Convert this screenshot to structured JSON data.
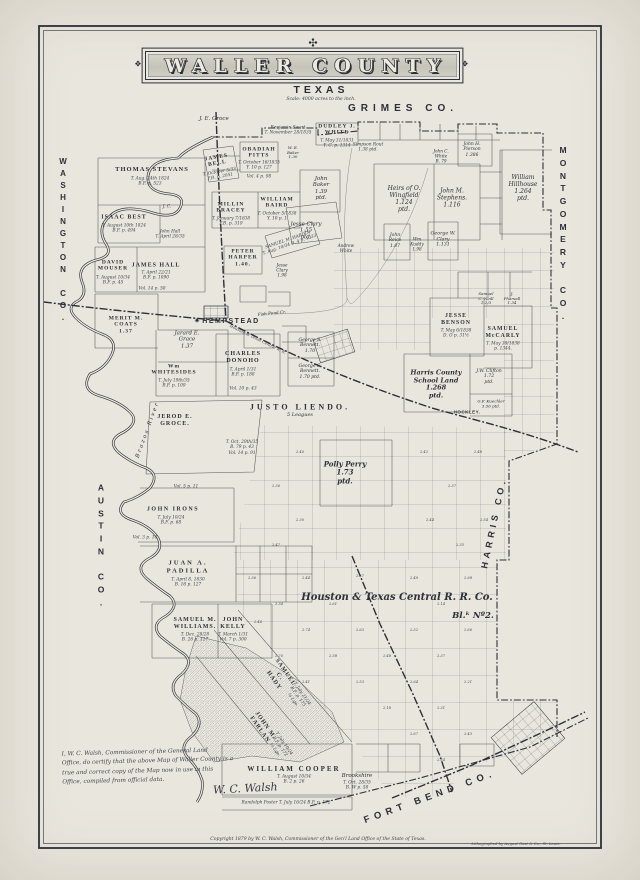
{
  "page": {
    "paper": "#e9e6de",
    "ink": "#2c3038"
  },
  "title": {
    "name": "WALLER COUNTY",
    "state": "TEXAS",
    "scale": "Scale: 4000 acres to the inch."
  },
  "icons": {
    "ornament_top": "✣",
    "banner_side": "❖",
    "courthouse_star": "✷"
  },
  "certificate": {
    "lines": [
      "I, W. C. Walsh, Commissioner of the General Land",
      "Office, do certify that the above Map of Waller County is a",
      "true and correct copy of the Map now in use in this",
      "Office, compiled from official data."
    ],
    "signature": "W. C. Walsh"
  },
  "footer": {
    "copyright": "Copyright 1879 by W. C. Walsh, Commissioner of the Gen'l Land Office of the State of Texas.",
    "lithographer": "Lithographed by August Gast & Co., St. Louis."
  },
  "map_labels": [
    {
      "n": "county-washington",
      "t": "WASHINGTON CO.",
      "x": 63,
      "y": 240,
      "cls": "vstack",
      "fs": 8
    },
    {
      "n": "county-austin",
      "t": "AUSTIN CO.",
      "x": 101,
      "y": 545,
      "cls": "vstack",
      "fs": 8.5
    },
    {
      "n": "county-grimes",
      "t": "GRIMES CO.",
      "x": 403,
      "y": 109,
      "cls": "county-h",
      "fs": 10,
      "ls": 5
    },
    {
      "n": "county-montgomery",
      "t": "MONTGOMERY CO.",
      "x": 563,
      "y": 233,
      "cls": "vstack",
      "fs": 8.5
    },
    {
      "n": "county-harris",
      "t": "HARRIS CO.",
      "x": 494,
      "y": 523,
      "cls": "county-h",
      "fs": 9,
      "ls": 4,
      "rot": -78
    },
    {
      "n": "county-fortbend",
      "t": "FORT BEND CO.",
      "x": 430,
      "y": 797,
      "cls": "county-h",
      "fs": 9.5,
      "ls": 5,
      "rot": -20
    },
    {
      "n": "town-hempstead",
      "t": "HEMPSTEAD",
      "x": 231,
      "y": 322,
      "cls": "town",
      "fs": 7,
      "ls": 1.5
    },
    {
      "n": "courthouse-star",
      "t": "✷",
      "x": 197,
      "y": 322,
      "cls": "town",
      "fs": 6
    },
    {
      "n": "town-hockley",
      "t": "HOCKLEY.",
      "x": 467,
      "y": 412,
      "cls": "town",
      "fs": 4.5,
      "ls": 0.5
    },
    {
      "n": "town-brookshire",
      "t": "Brookshire",
      "x": 357,
      "y": 776,
      "cls": "script",
      "fs": 5.5
    },
    {
      "t": "T. Oct. 28/35\nB. W p. 58",
      "x": 357,
      "y": 786,
      "cls": "note"
    },
    {
      "t": "J. E. Groce",
      "x": 214,
      "y": 119,
      "cls": "script",
      "fs": 5.5
    },
    {
      "t": "THOMAS STEVANS",
      "x": 152,
      "y": 170,
      "cls": "caps",
      "fs": 6.5
    },
    {
      "t": "T. Aug. 24th 1824\nB.F. p. 523",
      "x": 150,
      "y": 182,
      "cls": "note"
    },
    {
      "t": "ISAAC BEST",
      "x": 124,
      "y": 218,
      "cls": "caps",
      "fs": 6
    },
    {
      "t": "T. August 10th 1824\nB.F. p. 494",
      "x": 124,
      "y": 229,
      "cls": "note"
    },
    {
      "t": "J. C.",
      "x": 167,
      "y": 207,
      "cls": "note"
    },
    {
      "t": "John Hall\nT. April 28/35",
      "x": 170,
      "y": 235,
      "cls": "note"
    },
    {
      "t": "DAVID\nMOUSER",
      "x": 113,
      "y": 266,
      "cls": "caps",
      "fs": 5.5
    },
    {
      "t": "T. August 10/34\nB.F. p. 45",
      "x": 113,
      "y": 281,
      "cls": "note"
    },
    {
      "t": "JAMES HALL",
      "x": 156,
      "y": 266,
      "cls": "caps",
      "fs": 6
    },
    {
      "t": "T. April 22/21\nB.F. p. 1090",
      "x": 156,
      "y": 276,
      "cls": "note"
    },
    {
      "t": "Vol. 14 p. 58",
      "x": 152,
      "y": 289,
      "cls": "note"
    },
    {
      "t": "MERIT M.\nCOATS\n1.37",
      "x": 126,
      "y": 325,
      "cls": "caps",
      "fs": 5.5
    },
    {
      "t": "Jarard E.\nGrace\n1.37",
      "x": 187,
      "y": 340,
      "cls": "script",
      "fs": 5.5
    },
    {
      "t": "Wm\nWHITESIDES",
      "x": 174,
      "y": 370,
      "cls": "caps",
      "fs": 5.5
    },
    {
      "t": "T. July 19th/35\nB.F. p. 109",
      "x": 174,
      "y": 384,
      "cls": "note"
    },
    {
      "t": "CHARLES\nDONOHO",
      "x": 243,
      "y": 358,
      "cls": "caps",
      "fs": 6
    },
    {
      "t": "T. April 1/31\nB.F. p. 188",
      "x": 243,
      "y": 373,
      "cls": "note"
    },
    {
      "t": "Vol. 10 p. 43",
      "x": 243,
      "y": 389,
      "cls": "note"
    },
    {
      "t": "JEROD E.\nGROCE.",
      "x": 175,
      "y": 421,
      "cls": "caps",
      "fs": 6
    },
    {
      "t": "T. Oct. 29th/35\nB. 79 p. 43\nVol. 14 p. 91",
      "x": 242,
      "y": 448,
      "cls": "note"
    },
    {
      "t": "Brazos River",
      "x": 148,
      "y": 430,
      "cls": "script",
      "fs": 5.5,
      "rot": -70,
      "ls": 2
    },
    {
      "t": "Vol. 5 p. 11",
      "x": 186,
      "y": 487,
      "cls": "note"
    },
    {
      "t": "JOHN IRONS",
      "x": 173,
      "y": 510,
      "cls": "caps",
      "fs": 6,
      "ls": 1.5
    },
    {
      "t": "T. July 10/24\nB.F. p. 68",
      "x": 171,
      "y": 521,
      "cls": "note"
    },
    {
      "t": "Vol. 3 p. 14",
      "x": 145,
      "y": 538,
      "cls": "note"
    },
    {
      "t": "JUAN A.\nPADILLA",
      "x": 188,
      "y": 567,
      "cls": "caps",
      "fs": 6.5,
      "ls": 2
    },
    {
      "t": "T. April 8, 1830\nB. 16 p. 127",
      "x": 188,
      "y": 583,
      "cls": "note"
    },
    {
      "t": "SAMUEL M.\nWILLIAMS.",
      "x": 195,
      "y": 624,
      "cls": "caps",
      "fs": 6
    },
    {
      "t": "T. Dec. 28/28\nB. 26 p. 117",
      "x": 195,
      "y": 638,
      "cls": "note"
    },
    {
      "t": "JOHN\nKELLY",
      "x": 233,
      "y": 624,
      "cls": "caps",
      "fs": 6
    },
    {
      "t": "T. March 1/31\nVol. 7 p. 300",
      "x": 233,
      "y": 638,
      "cls": "note"
    },
    {
      "t": "JAMES\nBELL",
      "x": 217,
      "y": 161,
      "cls": "caps",
      "fs": 5.5,
      "rot": -10
    },
    {
      "t": "T. October 5/33\nF.B. p. 2051",
      "x": 220,
      "y": 175,
      "cls": "note",
      "rot": -10
    },
    {
      "t": "OBADIAH\nPITTS",
      "x": 259,
      "y": 153,
      "cls": "caps",
      "fs": 5.5
    },
    {
      "t": "T. October 16/1835\nY. 10 p. 127",
      "x": 259,
      "y": 166,
      "cls": "note"
    },
    {
      "t": "Vol. 4 p. 98",
      "x": 259,
      "y": 177,
      "cls": "note"
    },
    {
      "t": "DUDLEY J.\nWHITE",
      "x": 337,
      "y": 130,
      "cls": "caps",
      "fs": 5.5
    },
    {
      "t": "T. May 31/1831\nY. C. p. 1314",
      "x": 337,
      "y": 144,
      "cls": "note"
    },
    {
      "t": "Benjamin Swart\nT. November 28/1835",
      "x": 288,
      "y": 131,
      "cls": "note"
    },
    {
      "t": "Simpson Rout\n1.38  ptd.",
      "x": 368,
      "y": 148,
      "cls": "note"
    },
    {
      "t": "W. E.\nBaker\n1.30",
      "x": 293,
      "y": 153,
      "cls": "script",
      "fs": 4
    },
    {
      "t": "MILLIN\nBRACEY",
      "x": 231,
      "y": 208,
      "cls": "caps",
      "fs": 5.5
    },
    {
      "t": "T. January 7/1838\nF.B. p. 319",
      "x": 231,
      "y": 222,
      "cls": "note"
    },
    {
      "t": "WILLIAM\nBAIRD",
      "x": 277,
      "y": 203,
      "cls": "caps",
      "fs": 5.5
    },
    {
      "t": "T. October 5/1838\nY. 10 p. 1",
      "x": 277,
      "y": 217,
      "cls": "note"
    },
    {
      "t": "John\nBaker\n1.39\nptd.",
      "x": 321,
      "y": 189,
      "cls": "script",
      "fs": 5.5
    },
    {
      "t": "Jesse Clary\n1.55\nptd.",
      "x": 306,
      "y": 231,
      "cls": "script",
      "fs": 5.5
    },
    {
      "t": "SAMUEL M. HARDIN\nT. Aug. 10/34  B. 4 p. 1033",
      "x": 289,
      "y": 243,
      "cls": "note",
      "rot": -19
    },
    {
      "t": "PETER\nHARPER\n1.40.",
      "x": 243,
      "y": 258,
      "cls": "caps",
      "fs": 5.5
    },
    {
      "t": "Jesse\nClary\n1.98",
      "x": 282,
      "y": 271,
      "cls": "script",
      "fs": 4.2
    },
    {
      "t": "Andrew\nWhite",
      "x": 346,
      "y": 249,
      "cls": "script",
      "fs": 4.2
    },
    {
      "t": "Heirs of O.\nWingfield\n1.124\nptd.",
      "x": 404,
      "y": 199,
      "cls": "script",
      "fs": 6
    },
    {
      "t": "John M.\nStephens.\n1.116",
      "x": 452,
      "y": 198,
      "cls": "script",
      "fs": 6
    },
    {
      "t": "William\nHillhouse\n1.264\nptd.",
      "x": 523,
      "y": 188,
      "cls": "script",
      "fs": 6
    },
    {
      "t": "John H.\nPierson\n1.386",
      "x": 472,
      "y": 150,
      "cls": "script",
      "fs": 4.5
    },
    {
      "t": "John C.\nWhite\nB. 79",
      "x": 441,
      "y": 157,
      "cls": "script",
      "fs": 4.2
    },
    {
      "t": "George W.\nClary\n1.131",
      "x": 443,
      "y": 240,
      "cls": "script",
      "fs": 4.8
    },
    {
      "t": "John\nReice\n1.87",
      "x": 395,
      "y": 241,
      "cls": "script",
      "fs": 4.5
    },
    {
      "t": "Wm\nKuddy\n1.98",
      "x": 417,
      "y": 245,
      "cls": "script",
      "fs": 4.2
    },
    {
      "t": "JESSE\nBENSON",
      "x": 456,
      "y": 320,
      "cls": "caps",
      "fs": 5.8
    },
    {
      "t": "T. May 6/1838\nD. O p. 31½",
      "x": 456,
      "y": 334,
      "cls": "note"
    },
    {
      "t": "SAMUEL\nMcCARLY",
      "x": 503,
      "y": 333,
      "cls": "caps",
      "fs": 5.8
    },
    {
      "t": "T. May 30/1838\np. 1344.",
      "x": 503,
      "y": 347,
      "cls": "note"
    },
    {
      "t": "Samuel\nC. Neill\n1.2/3",
      "x": 486,
      "y": 299,
      "cls": "script",
      "fs": 4
    },
    {
      "t": "J.\nPharsall\n1.34",
      "x": 512,
      "y": 299,
      "cls": "script",
      "fs": 4
    },
    {
      "t": "Harris County\nSchool Land\n1.268\nptd.",
      "x": 436,
      "y": 385,
      "cls": "sb",
      "fs": 6.5
    },
    {
      "t": "J.W. Clifton\n1.72\nptd.",
      "x": 489,
      "y": 377,
      "cls": "script",
      "fs": 4.6
    },
    {
      "t": "G.F. Kuechler\n3.56  ptd.",
      "x": 491,
      "y": 404,
      "cls": "script",
      "fs": 4
    },
    {
      "t": "George S.\nBennett.\n1.70",
      "x": 310,
      "y": 346,
      "cls": "script",
      "fs": 4.6
    },
    {
      "t": "George S.\nBennett.\n1.70  ptd.",
      "x": 310,
      "y": 372,
      "cls": "script",
      "fs": 4.6
    },
    {
      "t": "Fish Pond  Cr.",
      "x": 272,
      "y": 314,
      "cls": "script",
      "fs": 4.2,
      "rot": -6
    },
    {
      "t": "Houston & Texas Central R. R.",
      "x": 258,
      "y": 339,
      "cls": "note",
      "rot": 26,
      "fs": 4
    },
    {
      "t": "JUSTO LIENDO.",
      "x": 300,
      "y": 407,
      "cls": "caps",
      "fs": 8,
      "ls": 3
    },
    {
      "t": "5 Leagues",
      "x": 300,
      "y": 416,
      "cls": "script",
      "fs": 5
    },
    {
      "t": "Polly Perry\n1.73\nptd.",
      "x": 345,
      "y": 473,
      "cls": "sb",
      "fs": 7
    },
    {
      "t": "Houston & Texas Central R. R. Co.",
      "x": 397,
      "y": 598,
      "cls": "rr",
      "fs": 10
    },
    {
      "t": "Bl.ᵏ Nº2.",
      "x": 473,
      "y": 616,
      "cls": "rr",
      "fs": 8.5
    },
    {
      "t": "SAMUEL\nC.\nHADY",
      "x": 279,
      "y": 677,
      "cls": "caps",
      "fs": 6,
      "rot": 55,
      "ls": 1
    },
    {
      "t": "T. July 21/24\nB.F. p. 175\n¼ Lge.",
      "x": 297,
      "y": 697,
      "cls": "note",
      "rot": 55
    },
    {
      "t": "JOHN M.\nFARLAN",
      "x": 262,
      "y": 728,
      "cls": "caps",
      "fs": 6,
      "rot": 55
    },
    {
      "t": "T. July 10/24\nB.F. p. 172\n⅓ Lge.",
      "x": 279,
      "y": 747,
      "cls": "note",
      "rot": 55
    },
    {
      "t": "WILLIAM COOPER",
      "x": 294,
      "y": 769,
      "cls": "caps",
      "fs": 7,
      "ls": 2
    },
    {
      "t": "T. August 10/34\nB. 2 p. 26",
      "x": 294,
      "y": 780,
      "cls": "note"
    },
    {
      "t": "Randolph Foster   T. July 16/24   B.F. p. 172",
      "x": 286,
      "y": 803,
      "cls": "note"
    }
  ],
  "grid_numbers": [
    {
      "t": "2.56",
      "x": 252,
      "y": 578
    },
    {
      "t": "2.44",
      "x": 306,
      "y": 578
    },
    {
      "t": "2.57",
      "x": 360,
      "y": 576
    },
    {
      "t": "2.49",
      "x": 414,
      "y": 578
    },
    {
      "t": "2.68",
      "x": 468,
      "y": 578
    },
    {
      "t": "2.34",
      "x": 279,
      "y": 604
    },
    {
      "t": "2.61",
      "x": 333,
      "y": 604
    },
    {
      "t": "2.14",
      "x": 441,
      "y": 604
    },
    {
      "t": "2.46",
      "x": 258,
      "y": 622
    },
    {
      "t": "2.74",
      "x": 306,
      "y": 630
    },
    {
      "t": "2.63",
      "x": 360,
      "y": 630
    },
    {
      "t": "2.52",
      "x": 414,
      "y": 630
    },
    {
      "t": "2.66",
      "x": 468,
      "y": 630
    },
    {
      "t": "2.70",
      "x": 279,
      "y": 656
    },
    {
      "t": "2.58",
      "x": 333,
      "y": 656
    },
    {
      "t": "2.48",
      "x": 387,
      "y": 656
    },
    {
      "t": "2.37",
      "x": 441,
      "y": 656
    },
    {
      "t": "2.41",
      "x": 306,
      "y": 682
    },
    {
      "t": "2.53",
      "x": 360,
      "y": 682
    },
    {
      "t": "2.64",
      "x": 414,
      "y": 682
    },
    {
      "t": "2.21",
      "x": 468,
      "y": 682
    },
    {
      "t": "2.18",
      "x": 387,
      "y": 708
    },
    {
      "t": "2.31",
      "x": 441,
      "y": 708
    },
    {
      "t": "2.67",
      "x": 414,
      "y": 734
    },
    {
      "t": "2.43",
      "x": 468,
      "y": 734
    },
    {
      "t": "2.54",
      "x": 441,
      "y": 760
    },
    {
      "t": "2.40",
      "x": 300,
      "y": 452
    },
    {
      "t": "2.36",
      "x": 276,
      "y": 486
    },
    {
      "t": "2.30",
      "x": 300,
      "y": 520
    },
    {
      "t": "2.47",
      "x": 276,
      "y": 545
    },
    {
      "t": "2.42",
      "x": 424,
      "y": 452
    },
    {
      "t": "2.37",
      "x": 452,
      "y": 486
    },
    {
      "t": "2.54",
      "x": 484,
      "y": 520
    },
    {
      "t": "2.44",
      "x": 430,
      "y": 520
    },
    {
      "t": "2.35",
      "x": 460,
      "y": 545
    },
    {
      "t": "2.48",
      "x": 478,
      "y": 452
    }
  ]
}
